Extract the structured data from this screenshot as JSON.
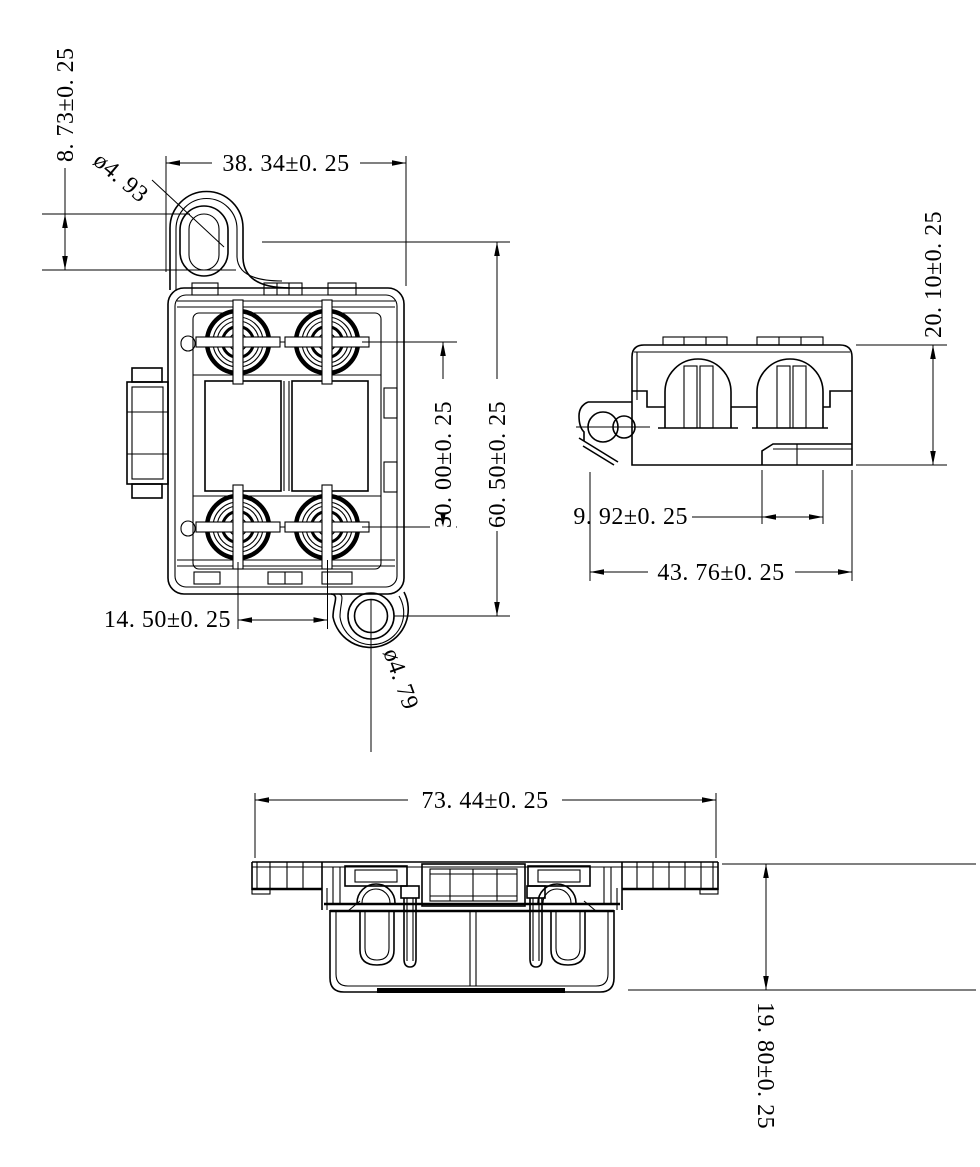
{
  "drawing": {
    "kind": "mechanical-part-3-view-dimension-drawing",
    "colors": {
      "ink": "#000000",
      "paper": "#ffffff"
    },
    "views": {
      "front": {
        "label": "front-view",
        "dims": {
          "slot_length": "8. 73±0. 25",
          "slot_diameter": "ø4. 93",
          "top_width": "38. 34±0. 25",
          "stud_pitch_vertical": "30. 00±0. 25",
          "hole_span": "60. 50±0. 25",
          "stud_spacing_horizontal": "14. 50±0. 25",
          "hole_diameter": "ø4. 79"
        }
      },
      "side": {
        "label": "side-view",
        "dims": {
          "height": "20. 10±0. 25",
          "step_width": "9. 92±0. 25",
          "overall_depth": "43. 76±0. 25"
        }
      },
      "bottom": {
        "label": "bottom-view",
        "dims": {
          "overall_width": "73. 44±0. 25",
          "height": "19. 80±0. 25"
        }
      }
    }
  }
}
